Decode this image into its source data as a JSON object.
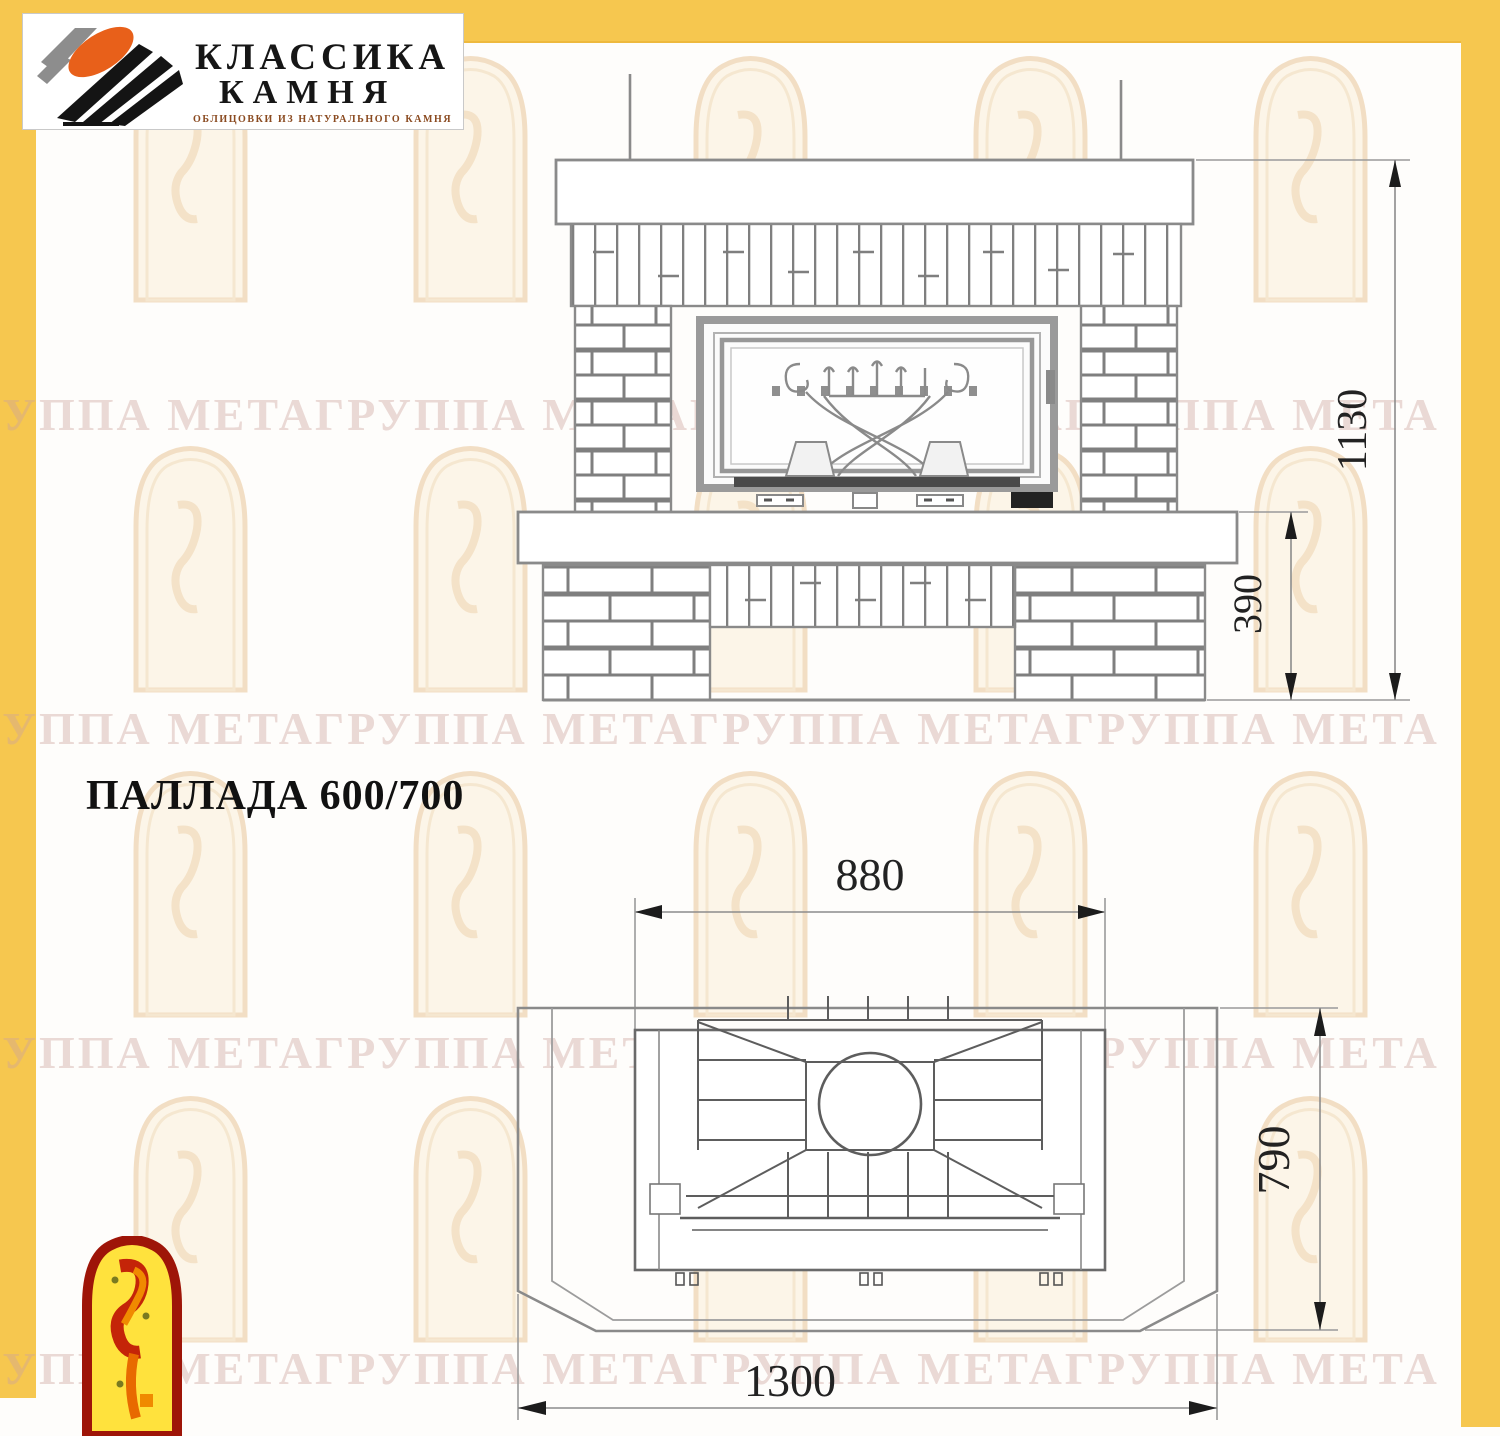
{
  "brand": {
    "name_line1": "КЛАССИКА",
    "name_line2": "КАМНЯ",
    "tagline": "ОБЛИЦОВКИ ИЗ НАТУРАЛЬНОГО КАМНЯ"
  },
  "title": "ПАЛЛАДА 600/700",
  "front_view": {
    "dims": {
      "total_height": "1130",
      "hearth_height": "390"
    }
  },
  "plan_view": {
    "dims": {
      "firebox_width": "880",
      "depth": "790",
      "total_width": "1300"
    }
  },
  "watermark": {
    "row_text": "ГРУППА МЕТАГРУППА МЕТАГРУППА МЕТАГРУППА МЕТА"
  },
  "colors": {
    "accent_yellow": "#f6c74f",
    "drawing_line": "#8a8a8a",
    "brand_orange": "#e8601a",
    "emblem_red": "#9e1508",
    "emblem_yellow": "#ffe23d"
  }
}
